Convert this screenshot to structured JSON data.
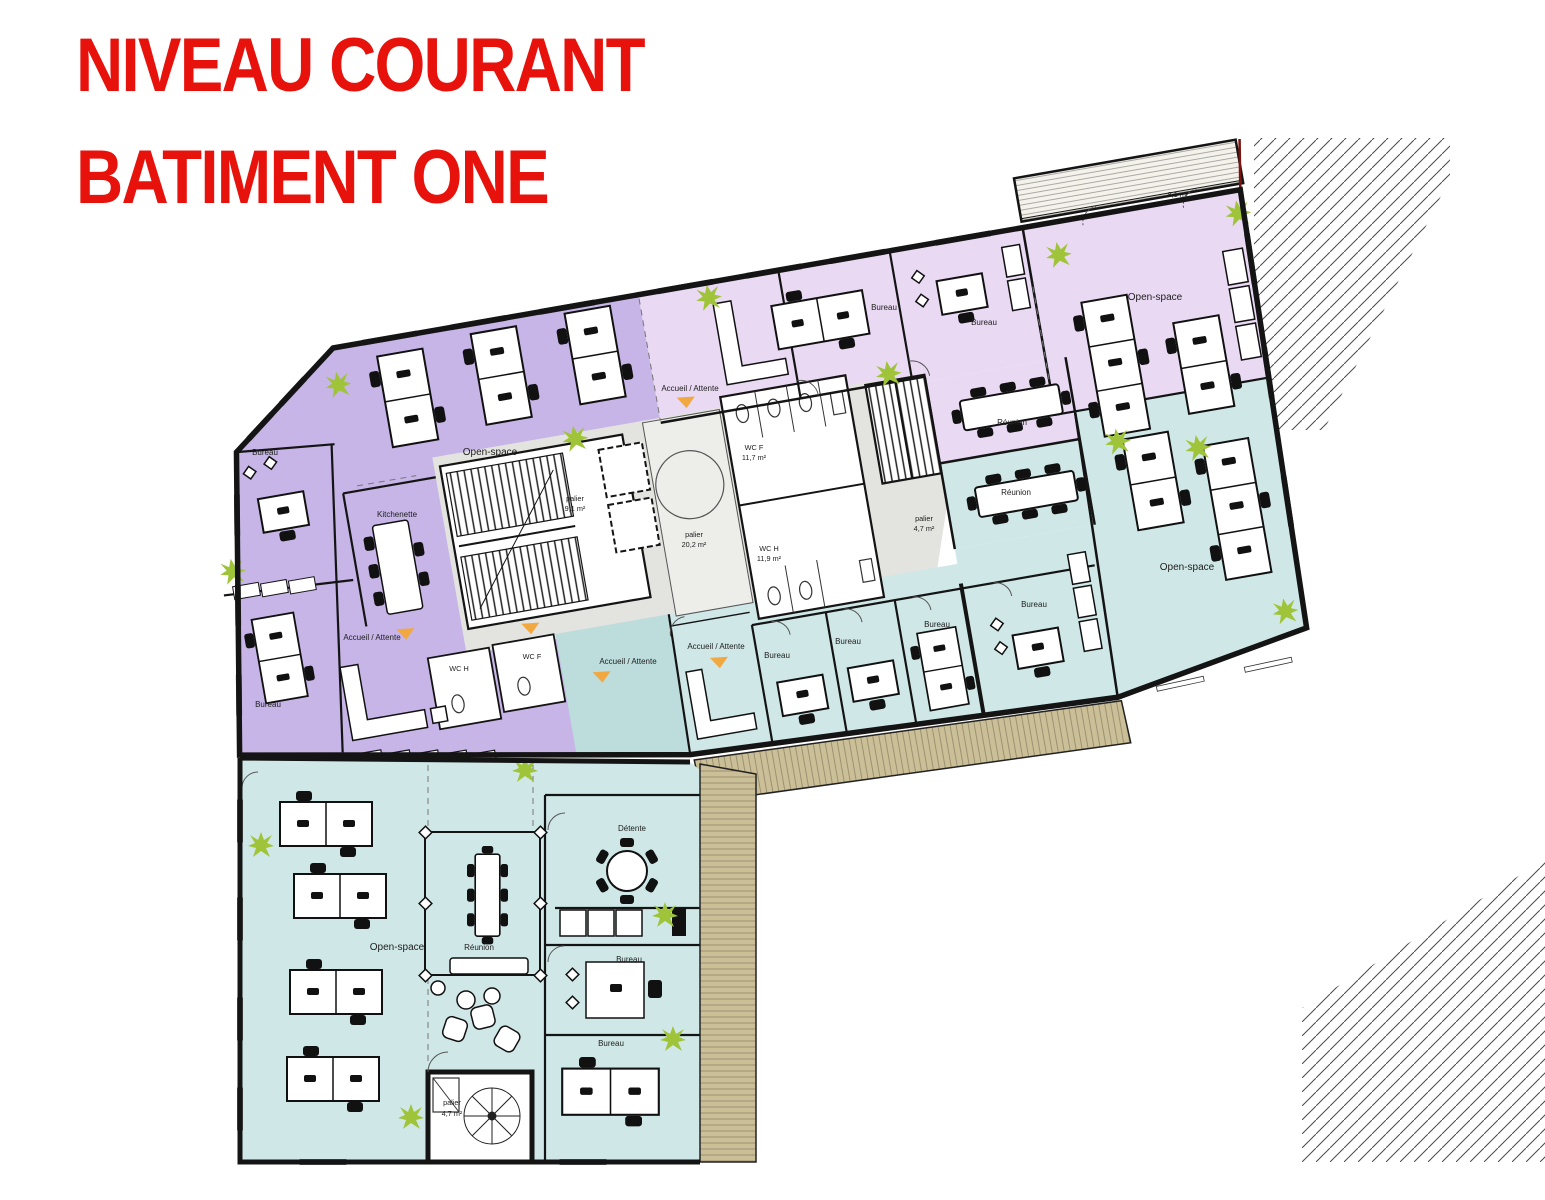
{
  "title": {
    "line1": "NIVEAU COURANT",
    "line2": "BATIMENT ONE"
  },
  "rooms": {
    "open_space": "Open-space",
    "bureau": "Bureau",
    "kitchenette": "Kitchenette",
    "accueil": "Accueil / Attente",
    "reunion": "Réunion",
    "detente": "Détente",
    "palier": "palier",
    "wc_f": "WC F",
    "wc_h": "WC H"
  },
  "areas": {
    "palier_left": "9,1 m²",
    "palier_central": "20,2 m²",
    "palier_right": "4,7 m²",
    "palier_bottom": "4,7 m²",
    "wc_f": "11,7 m²",
    "wc_h": "11,9 m²",
    "balcony": "8,1 m²"
  },
  "colors": {
    "title_red": "#e8120c",
    "zone_purple": "#c6b5e6",
    "zone_light_purple": "#e9d9f3",
    "zone_teal": "#cfe8e7",
    "zone_teal_dark": "#bddcdc",
    "core_gray": "#e3e3df",
    "core_light": "#ededea",
    "terrace_tan": "#cbbf98",
    "plant_green": "#9fc439",
    "accent_orange": "#f2a840",
    "boundary_red": "#7a1310",
    "wall_black": "#141414"
  }
}
